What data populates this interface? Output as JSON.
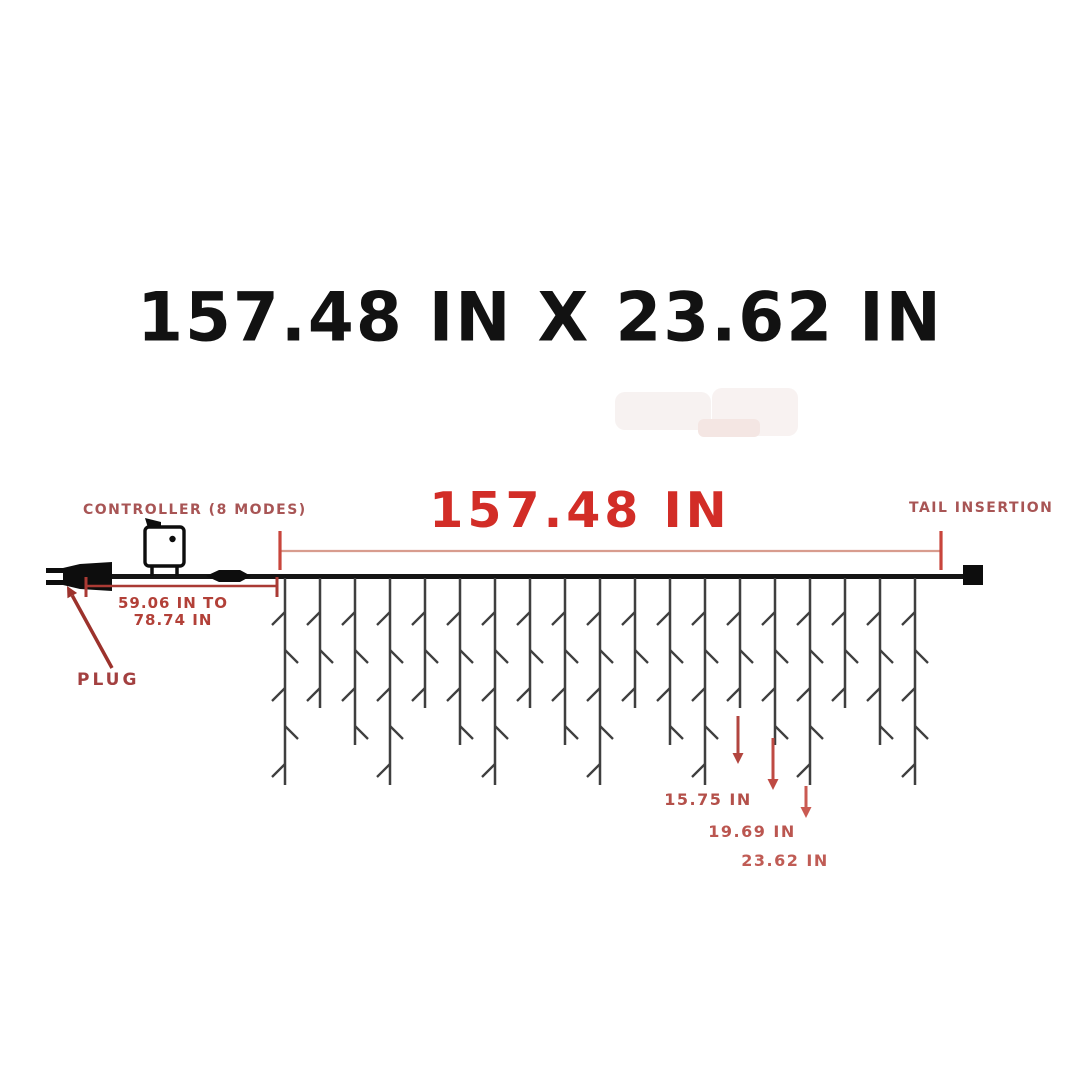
{
  "page": {
    "title": "157.48 IN X 23.62 IN"
  },
  "diagram": {
    "controller_label": "CONTROLLER (8 MODES)",
    "width_label": "157.48 IN",
    "tail_label": "TAIL INSERTION",
    "lead_range_line1": "59.06 IN TO",
    "lead_range_line2": "78.74 IN",
    "plug_label": "PLUG",
    "drop_measurements": [
      "15.75 IN",
      "19.69 IN",
      "23.62 IN"
    ]
  },
  "colors": {
    "title": "#121212",
    "accent_red": "#d22d27",
    "label_red": "#a85555",
    "dim_main_line": "#d89c8e",
    "dim_main_tick": "#c8453c",
    "dim_lead": "#aa3a34",
    "plug_arrow": "#9c322c",
    "drop_arrows": [
      "#b2453f",
      "#bf4a43",
      "#ca5a52"
    ],
    "wire": "#141414",
    "strand": "#3f3f3f",
    "hardware": "#0d0d0d"
  },
  "geometry": {
    "wire": {
      "x1": 110,
      "x2": 963,
      "y": 576.5,
      "width": 5
    },
    "tail_square": {
      "x": 963,
      "y": 565,
      "w": 20,
      "h": 20
    },
    "plug": {
      "body": [
        [
          112,
          562
        ],
        [
          80,
          564
        ],
        [
          63,
          568
        ],
        [
          63,
          585
        ],
        [
          80,
          589
        ],
        [
          112,
          591
        ]
      ],
      "prongs": [
        [
          46,
          568,
          18,
          5
        ],
        [
          46,
          580,
          18,
          5
        ]
      ]
    },
    "controller": {
      "box": [
        145,
        527,
        39,
        39
      ],
      "flag": [
        [
          148,
          528
        ],
        [
          145,
          518
        ],
        [
          161,
          522
        ],
        [
          161,
          528
        ]
      ],
      "dot": [
        172.5,
        539,
        3.2
      ],
      "legs": [
        152,
        177
      ],
      "leg_y2": 576
    },
    "connector": [
      [
        206,
        576
      ],
      [
        219,
        570
      ],
      [
        240,
        570
      ],
      [
        251,
        576
      ],
      [
        240,
        582
      ],
      [
        219,
        582
      ]
    ],
    "dim_main": {
      "x1": 280,
      "x2": 941,
      "y": 551,
      "tick_top": 531,
      "tick_bot": 570
    },
    "dim_lead": {
      "x1": 86,
      "x2": 277,
      "y": 586,
      "tick_top": 577,
      "tick_bot": 597
    },
    "curtain": {
      "first_x": 285,
      "spacing": 35,
      "count": 19,
      "top_y": 578,
      "length_pattern": [
        207,
        130,
        167
      ],
      "tick_start": 34,
      "tick_gap": 38,
      "tick_len": 13
    },
    "arrows": {
      "plug": {
        "x1": 112,
        "y1": 668,
        "x2": 67,
        "y2": 586
      },
      "drops": [
        {
          "x": 738,
          "y1": 716,
          "y2": 764
        },
        {
          "x": 773,
          "y1": 738,
          "y2": 790
        },
        {
          "x": 806,
          "y1": 786,
          "y2": 818
        }
      ]
    }
  }
}
